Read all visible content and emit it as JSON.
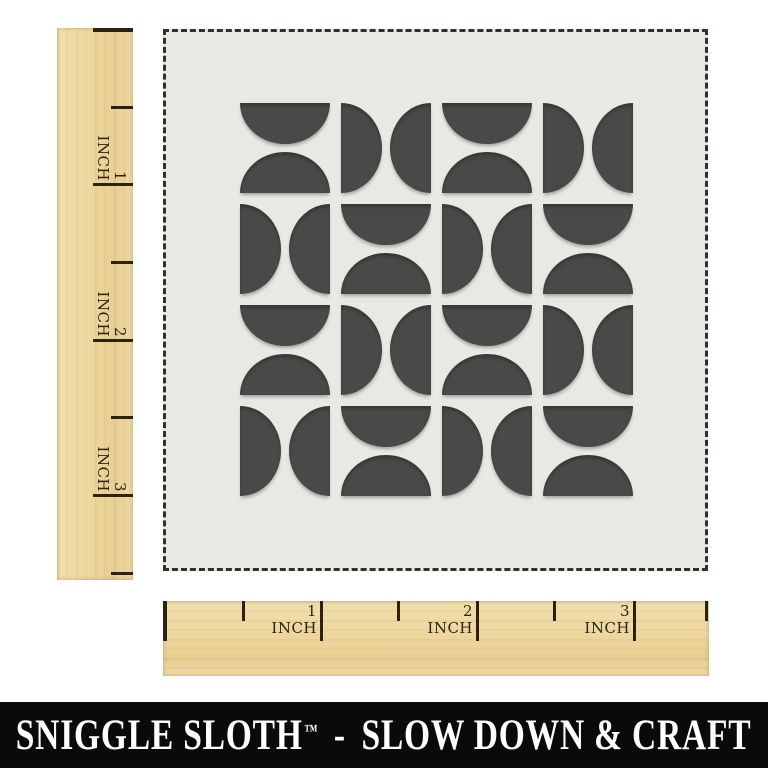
{
  "banner": {
    "brand": "SNIGGLE SLOTH",
    "trademark": "™",
    "separator": "-",
    "tagline": "SLOW DOWN & CRAFT",
    "bg_color": "#0a0a0a",
    "text_color": "#ffffff"
  },
  "rulers": {
    "unit_label": "INCH",
    "left_marks": [
      "1",
      "2",
      "3"
    ],
    "bottom_marks": [
      "1",
      "2",
      "3"
    ],
    "wood_color": "#eed8a0",
    "tick_color": "#2c2213"
  },
  "stencil": {
    "description": "4x4 grid of paired half-circle cutouts",
    "pattern_rows": [
      "VHVH",
      "HVHV",
      "VHVH",
      "HVHV"
    ],
    "shape_color": "#494947",
    "sheet_color": "#e9e8e5",
    "cut_border_color": "#33302a"
  }
}
